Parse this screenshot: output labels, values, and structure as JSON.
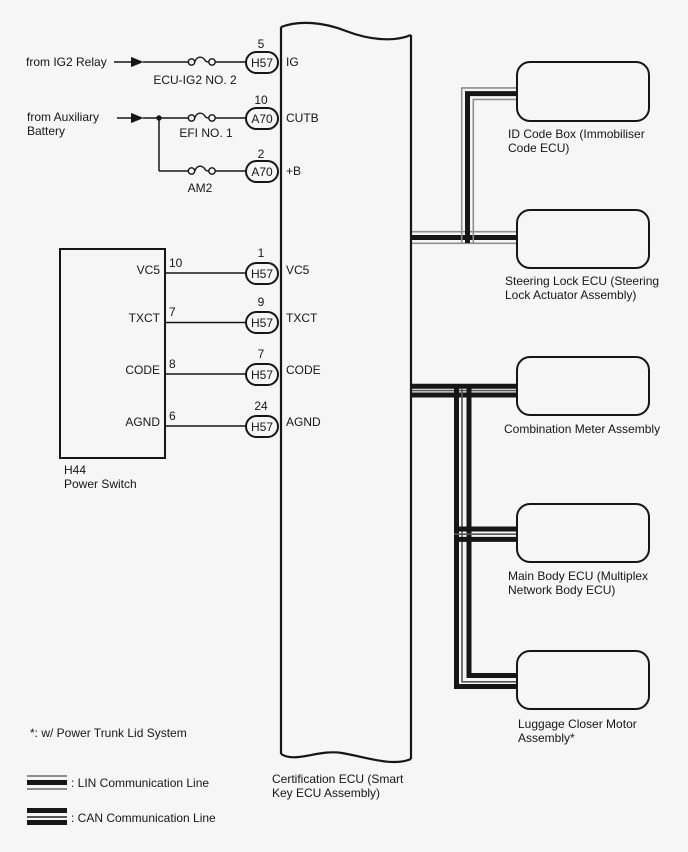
{
  "diagram_title": "Certification ECU (Smart Key ECU Assembly)",
  "ecu": {
    "label": "Certification ECU (Smart Key ECU Assembly)"
  },
  "power_feeds": [
    {
      "source": "from IG2 Relay",
      "fuse": "ECU-IG2 NO. 2",
      "pin": "5",
      "connector": "H57",
      "terminal": "IG"
    },
    {
      "source": "from Auxiliary\nBattery",
      "fuse": "EFI NO. 1",
      "pin": "10",
      "connector": "A70",
      "terminal": "CUTB"
    },
    {
      "source": "",
      "fuse": "AM2",
      "pin": "2",
      "connector": "A70",
      "terminal": "+B"
    }
  ],
  "power_switch": {
    "code_label": "H44\nPower Switch",
    "pins": [
      {
        "name": "VC5",
        "switch_pin": "10",
        "ecu_pin": "1",
        "connector": "H57",
        "ecu_terminal": "VC5"
      },
      {
        "name": "TXCT",
        "switch_pin": "7",
        "ecu_pin": "9",
        "connector": "H57",
        "ecu_terminal": "TXCT"
      },
      {
        "name": "CODE",
        "switch_pin": "8",
        "ecu_pin": "7",
        "connector": "H57",
        "ecu_terminal": "CODE"
      },
      {
        "name": "AGND",
        "switch_pin": "6",
        "ecu_pin": "24",
        "connector": "H57",
        "ecu_terminal": "AGND"
      }
    ]
  },
  "lin_devices": [
    {
      "label": "ID Code Box (Immobiliser Code ECU)"
    },
    {
      "label": "Steering Lock ECU (Steering Lock Actuator Assembly)"
    }
  ],
  "can_devices": [
    {
      "label": "Combination Meter Assembly"
    },
    {
      "label": "Main Body ECU (Multiplex Network Body ECU)"
    },
    {
      "label": "Luggage Closer Motor Assembly*"
    }
  ],
  "legend": {
    "footnote": "*: w/ Power Trunk Lid System",
    "lin_label": ": LIN Communication Line",
    "can_label": ": CAN Communication Line"
  },
  "colors": {
    "line": "#161616",
    "thin_gray": "#8e8e8e",
    "can_thin": "#555555",
    "background": "#f6f6f6"
  }
}
